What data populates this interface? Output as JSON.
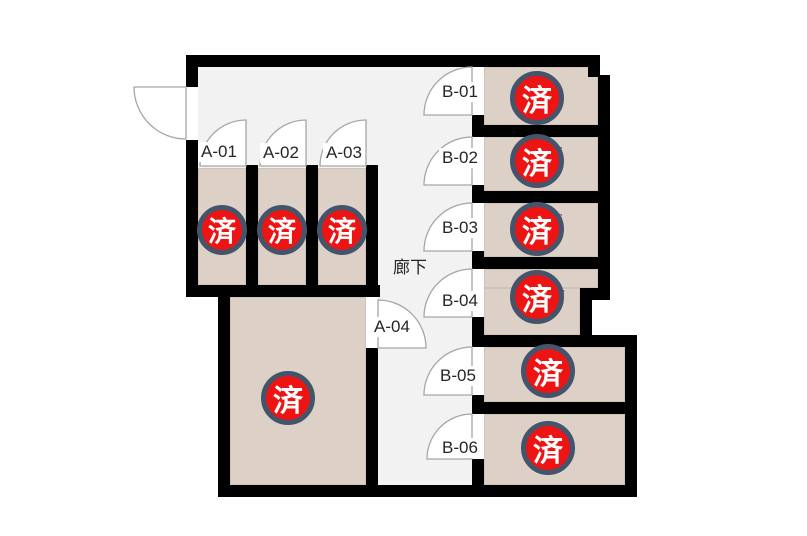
{
  "floorplan": {
    "corridor_label": "廊下",
    "stamp_text": "済",
    "colors": {
      "wall": "#000000",
      "room_fill": "#ddd1c7",
      "corridor_fill": "#f2f2f2",
      "stamp_red": "#ee1414",
      "stamp_ring": "#44546a",
      "door_line": "#a6a6a6",
      "label_text": "#262626"
    },
    "rooms": [
      {
        "label": "A-01",
        "stamp": "済",
        "fragment": "2"
      },
      {
        "label": "A-02",
        "stamp": "済",
        "fragment": "5"
      },
      {
        "label": "A-03",
        "stamp": "済",
        "fragment": "2"
      },
      {
        "label": "A-04",
        "stamp": "済",
        "fragment": ""
      },
      {
        "label": "B-01",
        "stamp": "済",
        "fragment": ""
      },
      {
        "label": "B-02",
        "stamp": "済",
        "fragment": "²"
      },
      {
        "label": "B-03",
        "stamp": "済",
        "fragment": "²"
      },
      {
        "label": "B-04",
        "stamp": "済",
        "fragment": "m²"
      },
      {
        "label": "B-05",
        "stamp": "済",
        "fragment": "m²"
      },
      {
        "label": "B-06",
        "stamp": "済",
        "fragment": "²"
      }
    ]
  }
}
